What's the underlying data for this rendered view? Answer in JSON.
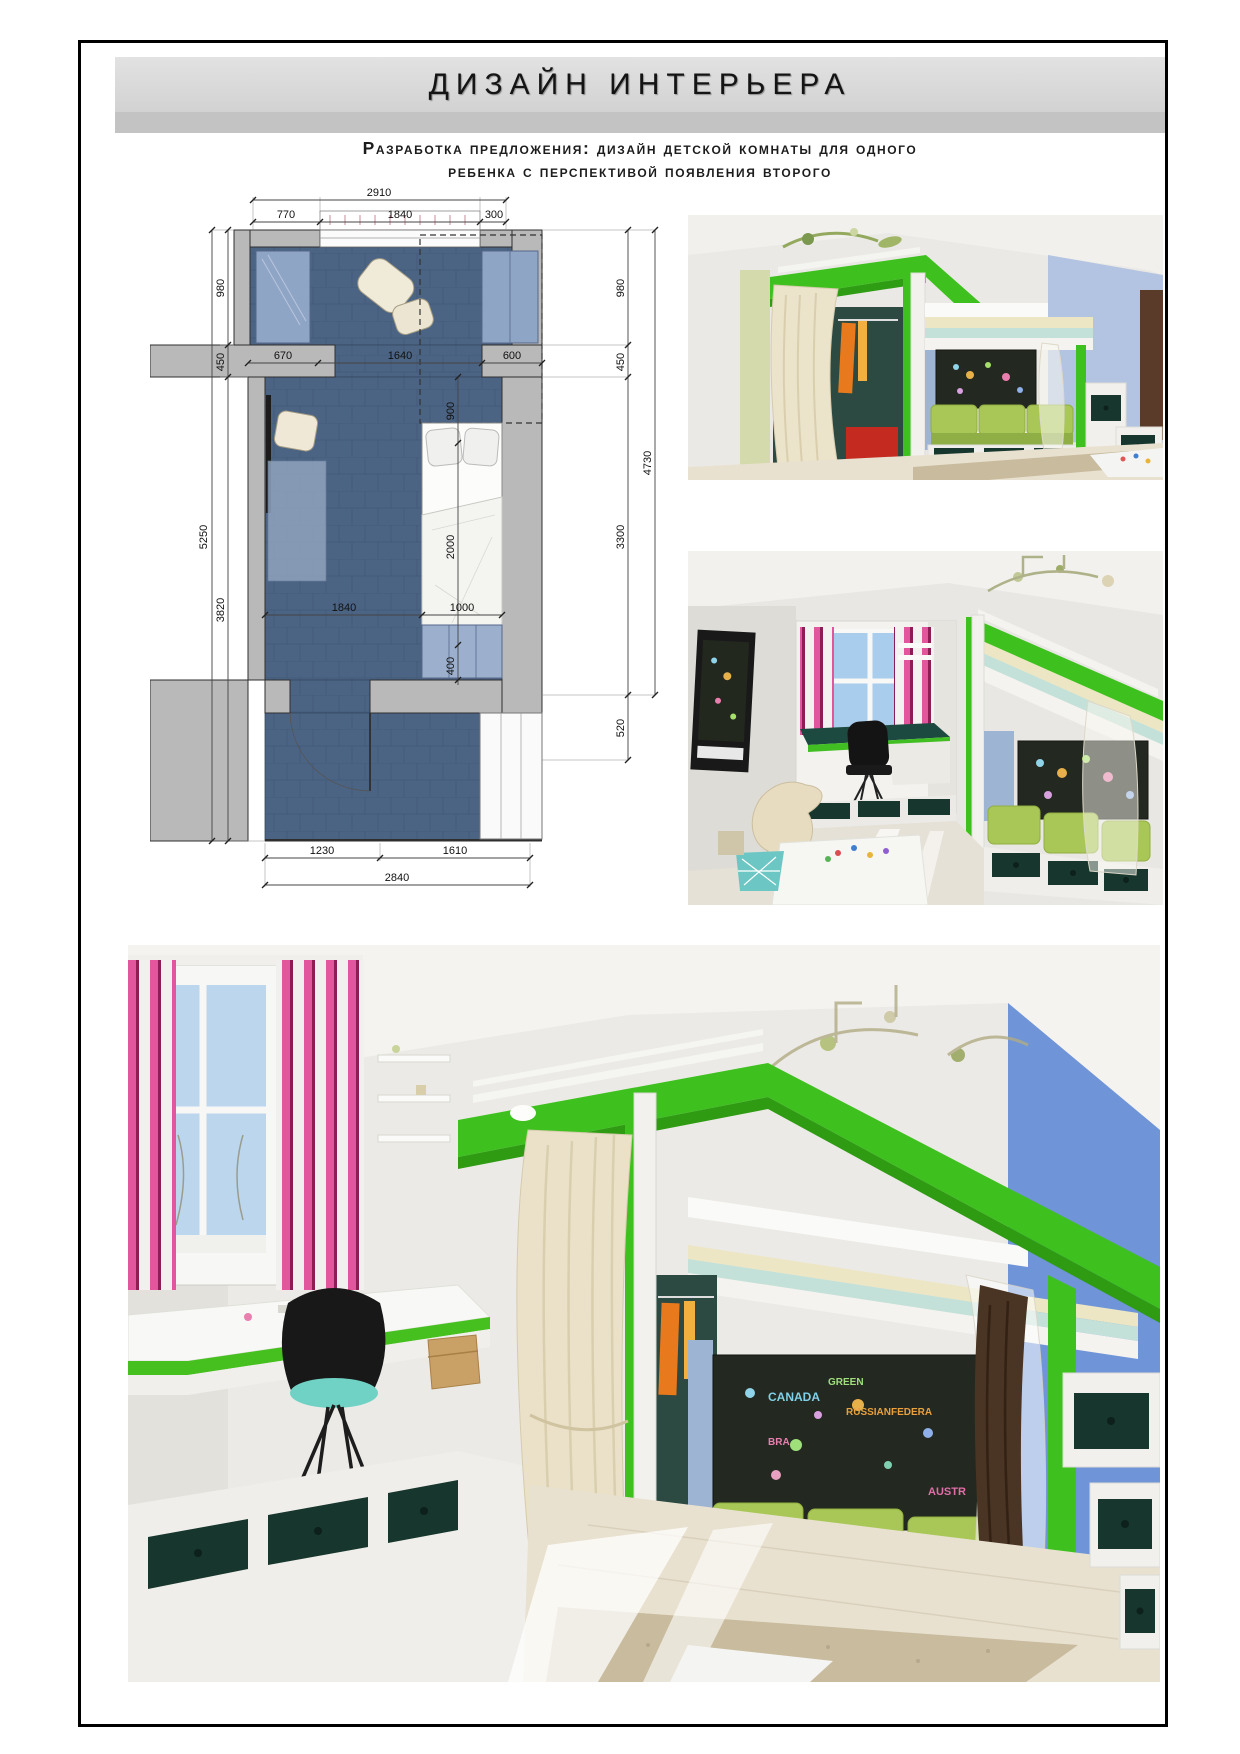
{
  "page": {
    "title": "ДИЗАЙН ИНТЕРЬЕРА",
    "subtitle_line1": "Разработка предложения: дизайн детской комнаты для одного",
    "subtitle_line2": "ребенка с перспективой появления второго"
  },
  "plan": {
    "dims": {
      "top_total": "2910",
      "top": [
        "770",
        "1840",
        "300"
      ],
      "left_outer": "5250",
      "left": [
        "980",
        "450",
        "3820"
      ],
      "right_outer": "4730",
      "right": [
        "980",
        "450",
        "3300",
        "520"
      ],
      "mid_row": [
        "670",
        "1640",
        "600"
      ],
      "mid_col": [
        "900",
        "2000",
        "400"
      ],
      "bed_row": [
        "1840",
        "1000"
      ],
      "bottom": [
        "1230",
        "1610"
      ],
      "bottom_total": "2840"
    }
  },
  "renders": {
    "map_words": [
      "CANADA",
      "GREEN",
      "RUSSIANFEDERA",
      "BRA",
      "AUSTR"
    ]
  },
  "colors": {
    "accent_green": "#3ec11e",
    "cushion_green": "#a8c757",
    "drawer_teal": "#17362e",
    "plan_floor_blue": "#4c6484",
    "wall_blue": "#6f94d8",
    "curtain_pink": "#e1569c",
    "banner_gray": "#d9d9d9"
  }
}
